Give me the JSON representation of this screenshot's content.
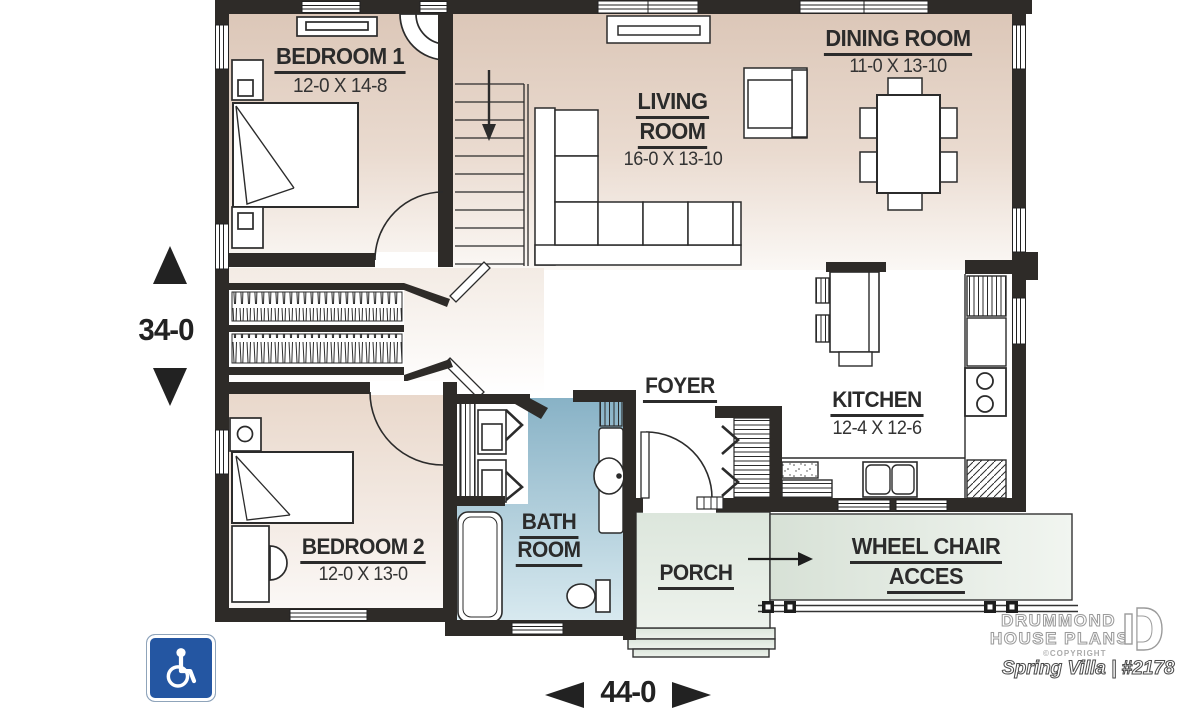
{
  "rooms": {
    "bedroom1": {
      "name": "BEDROOM 1",
      "dims": "12-0 X 14-8"
    },
    "living": {
      "line1": "LIVING",
      "line2": "ROOM",
      "dims": "16-0 X 13-10"
    },
    "dining": {
      "name": "DINING ROOM",
      "dims": "11-0 X 13-10"
    },
    "foyer": {
      "name": "FOYER"
    },
    "kitchen": {
      "name": "KITCHEN",
      "dims": "12-4 X 12-6"
    },
    "bedroom2": {
      "name": "BEDROOM 2",
      "dims": "12-0 X 13-0"
    },
    "bathroom": {
      "line1": "BATH",
      "line2": "ROOM"
    },
    "porch": {
      "name": "PORCH"
    },
    "ramp": {
      "line1": "WHEEL CHAIR",
      "line2": "ACCES"
    }
  },
  "dimensions": {
    "height": "34-0",
    "width": "44-0"
  },
  "branding": {
    "company_line1": "DRUMMOND",
    "company_line2": "HOUSE PLANS",
    "copyright": "©COPYRIGHT",
    "plan_name": "Spring Villa | #2178"
  },
  "icons": {
    "wheelchair": "wheelchair-accessible",
    "dim_arrow_up": "triangle-up",
    "dim_arrow_down": "triangle-down",
    "dim_arrow_left": "triangle-left",
    "dim_arrow_right": "triangle-right",
    "stairs_arrow": "arrow-down",
    "ramp_arrow": "arrow-right",
    "logo_mark": "drummond-d"
  },
  "colors": {
    "wall": "#2e2b28",
    "floor_beige": "#dcc7b8",
    "bathroom_blue": "#8ab4c7",
    "porch_green": "#dee8de",
    "wheelchair_blue": "#2456a2",
    "text": "#2b2b2b"
  }
}
